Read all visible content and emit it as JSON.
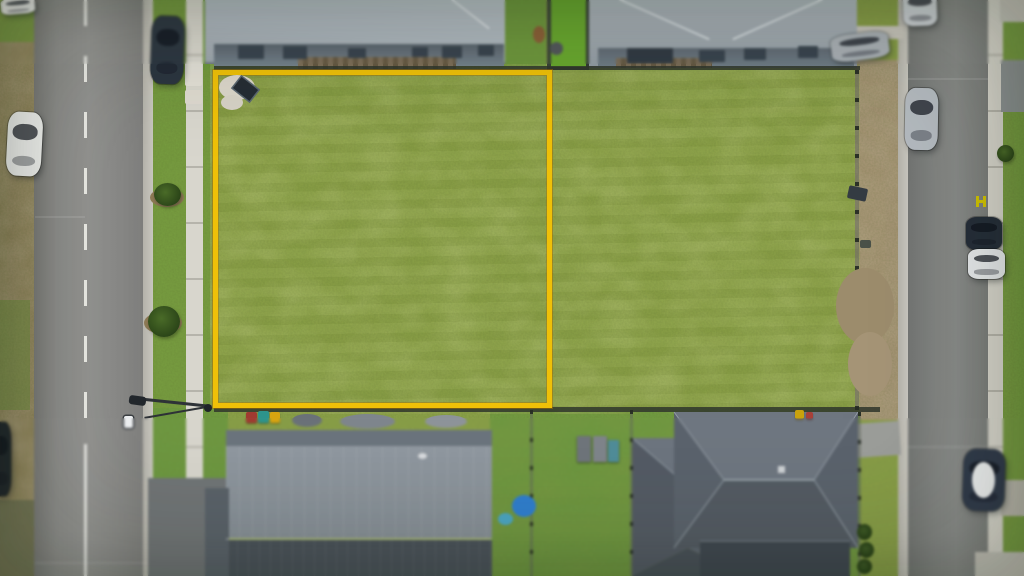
{
  "meta": {
    "description": "Aerial drone photograph of a vacant residential block of land outlined with a bright yellow property boundary, flanked by a wide street on the left and a narrower street on the right, with parked cars, footpaths, nature-strip trees, and new single-storey houses with grey hip roofs above and below the block.",
    "image_type": "real-estate-aerial-photo",
    "palette": {
      "boundary_yellow": "#efc008",
      "grass_field": "#8ba24a",
      "nature_strip": "#6f9a3c",
      "bright_lawn": "#68a72d",
      "road_asphalt": "#8c8c8a",
      "concrete_path": "#d6d4cb",
      "roof_light_grey": "#aeb7be",
      "roof_dark_grey": "#5a626c",
      "dirt": "#a09070"
    }
  },
  "scene": {
    "objects": [
      {
        "type": "blob",
        "name": "mulch-patch-1",
        "x": 150,
        "y": 188,
        "w": 34,
        "h": 19,
        "color": "#8d7a55"
      },
      {
        "type": "blob",
        "name": "mulch-patch-2",
        "x": 144,
        "y": 312,
        "w": 38,
        "h": 22,
        "color": "#8d7a55"
      },
      {
        "type": "blob",
        "name": "bare-dirt-patch-right-lot-1",
        "x": 836,
        "y": 268,
        "w": 58,
        "h": 76,
        "color": "#9c8c6c"
      },
      {
        "type": "blob",
        "name": "bare-dirt-patch-right-lot-2",
        "x": 848,
        "y": 332,
        "w": 44,
        "h": 64,
        "color": "#a59476"
      },
      {
        "type": "blob",
        "name": "bare-soil-patch-boundary-1",
        "x": 219,
        "y": 75,
        "w": 36,
        "h": 25,
        "color": "#dbd6ca"
      },
      {
        "type": "blob",
        "name": "bare-soil-patch-boundary-2",
        "x": 221,
        "y": 95,
        "w": 22,
        "h": 15,
        "color": "#d7d2c6"
      },
      {
        "type": "mark",
        "name": "concrete-pad-1",
        "x": 185,
        "y": 62,
        "w": 17,
        "h": 24,
        "color": "#e2dfd6",
        "radius": "2px"
      },
      {
        "type": "mark",
        "name": "concrete-pad-2",
        "x": 185,
        "y": 90,
        "w": 17,
        "h": 14,
        "color": "#ded9cf",
        "radius": "2px"
      },
      {
        "type": "tree",
        "name": "street-tree-1",
        "x": 154,
        "y": 183,
        "w": 27,
        "h": 23
      },
      {
        "type": "tree",
        "name": "street-tree-2",
        "x": 148,
        "y": 306,
        "w": 32,
        "h": 31
      },
      {
        "type": "tree",
        "name": "street-tree-3",
        "x": 997,
        "y": 145,
        "w": 17,
        "h": 17
      },
      {
        "type": "blob",
        "name": "dog-on-grass",
        "x": 533,
        "y": 26,
        "w": 12,
        "h": 17,
        "color": "#8a5f36"
      },
      {
        "type": "blob",
        "name": "shrub-by-lawn",
        "x": 550,
        "y": 42,
        "w": 13,
        "h": 13,
        "color": "#50565a"
      },
      {
        "type": "panel",
        "name": "solar-panel-on-ground",
        "x": 235,
        "y": 82,
        "w": 21,
        "h": 14,
        "rot": 38,
        "color": "#252c34"
      },
      {
        "type": "car",
        "name": "white-van-top-left",
        "x": 1,
        "y": -2,
        "w": 34,
        "h": 16,
        "rot": -5,
        "color": "#e8e9e7"
      },
      {
        "type": "car",
        "name": "white-car-left-shoulder",
        "x": 7,
        "y": 112,
        "w": 35,
        "h": 64,
        "rot": 3,
        "color": "#f0f1ef"
      },
      {
        "type": "car",
        "name": "dark-suv-left-kerb",
        "x": 151,
        "y": 16,
        "w": 33,
        "h": 68,
        "rot": 2,
        "color": "#2b3540"
      },
      {
        "type": "car",
        "name": "dark-car-left-edge",
        "x": -9,
        "y": 422,
        "w": 20,
        "h": 74,
        "color": "#1f252b"
      },
      {
        "type": "car",
        "name": "silver-car-right-road-top",
        "x": 903,
        "y": -9,
        "w": 34,
        "h": 35,
        "rot": -2,
        "color": "#cbd0d4"
      },
      {
        "type": "car",
        "name": "grey-car-driveway-top-right",
        "x": 831,
        "y": 33,
        "w": 58,
        "h": 27,
        "rot": -7,
        "color": "#a8afb5"
      },
      {
        "type": "car",
        "name": "silver-car-right-road-mid",
        "x": 905,
        "y": 88,
        "w": 33,
        "h": 62,
        "rot": 1,
        "color": "#b5bbc1"
      },
      {
        "type": "car",
        "name": "dark-car-right-road",
        "x": 966,
        "y": 217,
        "w": 36,
        "h": 33,
        "color": "#242d39"
      },
      {
        "type": "car",
        "name": "white-car-right-road-1",
        "x": 968,
        "y": 249,
        "w": 37,
        "h": 30,
        "color": "#e7eaec"
      },
      {
        "type": "car",
        "name": "white-roof-car-right-road-2",
        "x": 963,
        "y": 449,
        "w": 42,
        "h": 62,
        "rot": 2,
        "color": "#2e3849"
      },
      {
        "type": "blob",
        "name": "white-roof-car-roof",
        "x": 972,
        "y": 462,
        "w": 23,
        "h": 36,
        "color": "#eef0f1"
      },
      {
        "type": "bin",
        "name": "red-wheelie-bin",
        "x": 246,
        "y": 412,
        "w": 11,
        "h": 11,
        "color": "#a03a30"
      },
      {
        "type": "bin",
        "name": "teal-wheelie-bin",
        "x": 258,
        "y": 411,
        "w": 11,
        "h": 12,
        "color": "#2d948c"
      },
      {
        "type": "bin",
        "name": "yellow-wheelie-bin",
        "x": 270,
        "y": 412,
        "w": 10,
        "h": 11,
        "color": "#d8a410"
      },
      {
        "type": "bin",
        "name": "yellow-bin-far",
        "x": 795,
        "y": 410,
        "w": 9,
        "h": 9,
        "color": "#c9a20c"
      },
      {
        "type": "bin",
        "name": "red-bin-far",
        "x": 806,
        "y": 412,
        "w": 7,
        "h": 7,
        "color": "#a84038"
      },
      {
        "type": "blob",
        "name": "clutter-grey-1",
        "x": 292,
        "y": 414,
        "w": 30,
        "h": 13,
        "color": "#6a7178"
      },
      {
        "type": "blob",
        "name": "clutter-grey-2",
        "x": 340,
        "y": 414,
        "w": 55,
        "h": 15,
        "color": "#7e858c"
      },
      {
        "type": "blob",
        "name": "clutter-grey-3",
        "x": 425,
        "y": 415,
        "w": 42,
        "h": 13,
        "color": "#8d9399"
      },
      {
        "type": "blob",
        "name": "blue-paddling-pool",
        "x": 512,
        "y": 495,
        "w": 24,
        "h": 22,
        "color": "#2e7ed0"
      },
      {
        "type": "blob",
        "name": "teal-garden-item",
        "x": 498,
        "y": 513,
        "w": 15,
        "h": 12,
        "color": "#4aa6c4"
      },
      {
        "type": "shed",
        "name": "garden-shed-1",
        "x": 577,
        "y": 436,
        "w": 14,
        "h": 26,
        "color": "#6e747a"
      },
      {
        "type": "shed",
        "name": "garden-shed-2",
        "x": 593,
        "y": 436,
        "w": 14,
        "h": 26,
        "color": "#7e848a"
      },
      {
        "type": "shed",
        "name": "garden-shed-3",
        "x": 608,
        "y": 440,
        "w": 11,
        "h": 22,
        "color": "#4e8c98"
      },
      {
        "type": "mark",
        "name": "box-trailer-right-lot",
        "x": 848,
        "y": 187,
        "w": 19,
        "h": 13,
        "rot": 12,
        "color": "#343b42",
        "radius": "2px"
      },
      {
        "type": "mark",
        "name": "small-dark-object-right-lot",
        "x": 860,
        "y": 240,
        "w": 11,
        "h": 8,
        "color": "#4a5148",
        "radius": "2px"
      },
      {
        "type": "bush",
        "name": "hedge-bottom-right-1",
        "x": 857,
        "y": 524,
        "w": 15,
        "h": 16
      },
      {
        "type": "bush",
        "name": "hedge-bottom-right-2",
        "x": 859,
        "y": 542,
        "w": 15,
        "h": 16
      },
      {
        "type": "bush",
        "name": "hedge-bottom-right-3",
        "x": 857,
        "y": 559,
        "w": 15,
        "h": 15
      },
      {
        "type": "bar",
        "name": "streetlight-arm-upper",
        "x": 138,
        "y": 401,
        "w": 72,
        "h": 3,
        "rot": 6,
        "color": "#2e3237"
      },
      {
        "type": "bar",
        "name": "streetlight-arm-lower",
        "x": 144,
        "y": 411,
        "w": 68,
        "h": 2,
        "rot": -10,
        "color": "#2e3237"
      },
      {
        "type": "mark",
        "name": "streetlight-head-dark",
        "x": 129,
        "y": 396,
        "w": 17,
        "h": 9,
        "rot": 8,
        "color": "#23282d",
        "radius": "3px"
      },
      {
        "type": "lamp-white",
        "name": "streetlight-head-white",
        "x": 124,
        "y": 416,
        "w": 9,
        "h": 12,
        "color": "#eef0f2",
        "radius": "2px"
      },
      {
        "type": "mark",
        "name": "streetlight-base",
        "x": 204,
        "y": 404,
        "w": 8,
        "h": 8,
        "color": "#1f2429",
        "radius": "50%"
      },
      {
        "type": "mark",
        "name": "hydrant-road-mark-left-bar",
        "x": 976,
        "y": 196,
        "w": 3,
        "h": 11,
        "color": "#d2c300"
      },
      {
        "type": "mark",
        "name": "hydrant-road-mark-right-bar",
        "x": 983,
        "y": 196,
        "w": 3,
        "h": 11,
        "color": "#d2c300"
      },
      {
        "type": "mark",
        "name": "hydrant-road-mark-crossbar",
        "x": 976,
        "y": 200,
        "w": 10,
        "h": 3,
        "color": "#d2c300"
      },
      {
        "type": "window",
        "name": "house1-window-1",
        "x": 238,
        "y": 45,
        "w": 26,
        "h": 14
      },
      {
        "type": "window",
        "name": "house1-window-2",
        "x": 283,
        "y": 46,
        "w": 24,
        "h": 13
      },
      {
        "type": "window",
        "name": "house1-window-3",
        "x": 348,
        "y": 48,
        "w": 18,
        "h": 10
      },
      {
        "type": "window",
        "name": "house1-window-4",
        "x": 412,
        "y": 47,
        "w": 16,
        "h": 10
      },
      {
        "type": "window",
        "name": "house1-window-5",
        "x": 442,
        "y": 46,
        "w": 20,
        "h": 12
      },
      {
        "type": "window",
        "name": "house1-window-6",
        "x": 478,
        "y": 45,
        "w": 16,
        "h": 11
      },
      {
        "type": "window",
        "name": "house2-porch",
        "x": 627,
        "y": 48,
        "w": 46,
        "h": 15,
        "color": "#2f3842"
      },
      {
        "type": "window",
        "name": "house2-window-1",
        "x": 699,
        "y": 50,
        "w": 26,
        "h": 12
      },
      {
        "type": "window",
        "name": "house2-window-2",
        "x": 744,
        "y": 48,
        "w": 22,
        "h": 12
      },
      {
        "type": "window",
        "name": "house2-window-3",
        "x": 798,
        "y": 46,
        "w": 20,
        "h": 12
      },
      {
        "type": "mark",
        "name": "roof-vent-bottom-house",
        "x": 418,
        "y": 453,
        "w": 9,
        "h": 6,
        "color": "#d8dbde",
        "radius": "50%"
      }
    ]
  }
}
